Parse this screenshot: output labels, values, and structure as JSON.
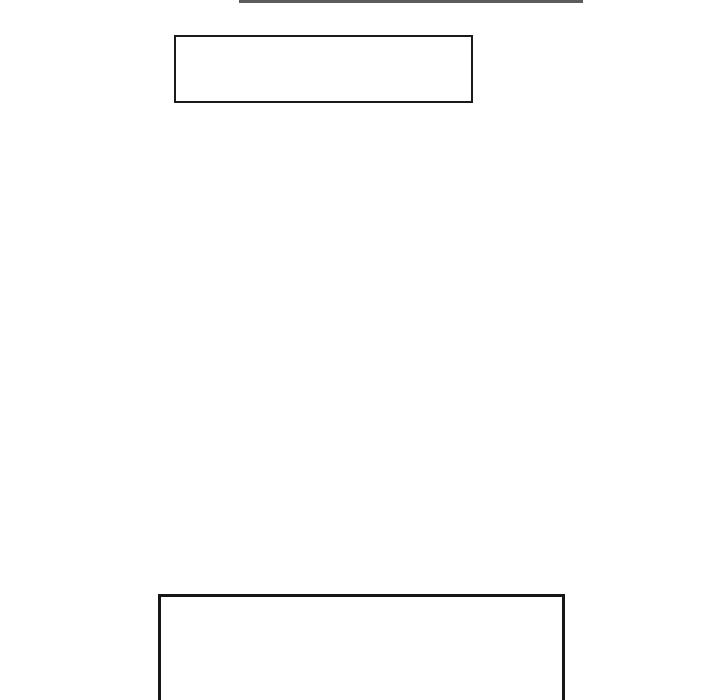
{
  "page": {
    "background": "#ffffff",
    "kind": "blank-page-with-empty-rectangle-outlines"
  },
  "colors": {
    "page-bg": "#ffffff",
    "top-line": "#5c5c5c",
    "upper-box-border": "#1b1b1b",
    "lower-box-border": "#161616"
  },
  "shapes": [
    {
      "name": "cropped-box-bottom-edge",
      "text": ""
    },
    {
      "name": "upper-empty-box",
      "text": ""
    },
    {
      "name": "lower-empty-box",
      "text": ""
    }
  ]
}
